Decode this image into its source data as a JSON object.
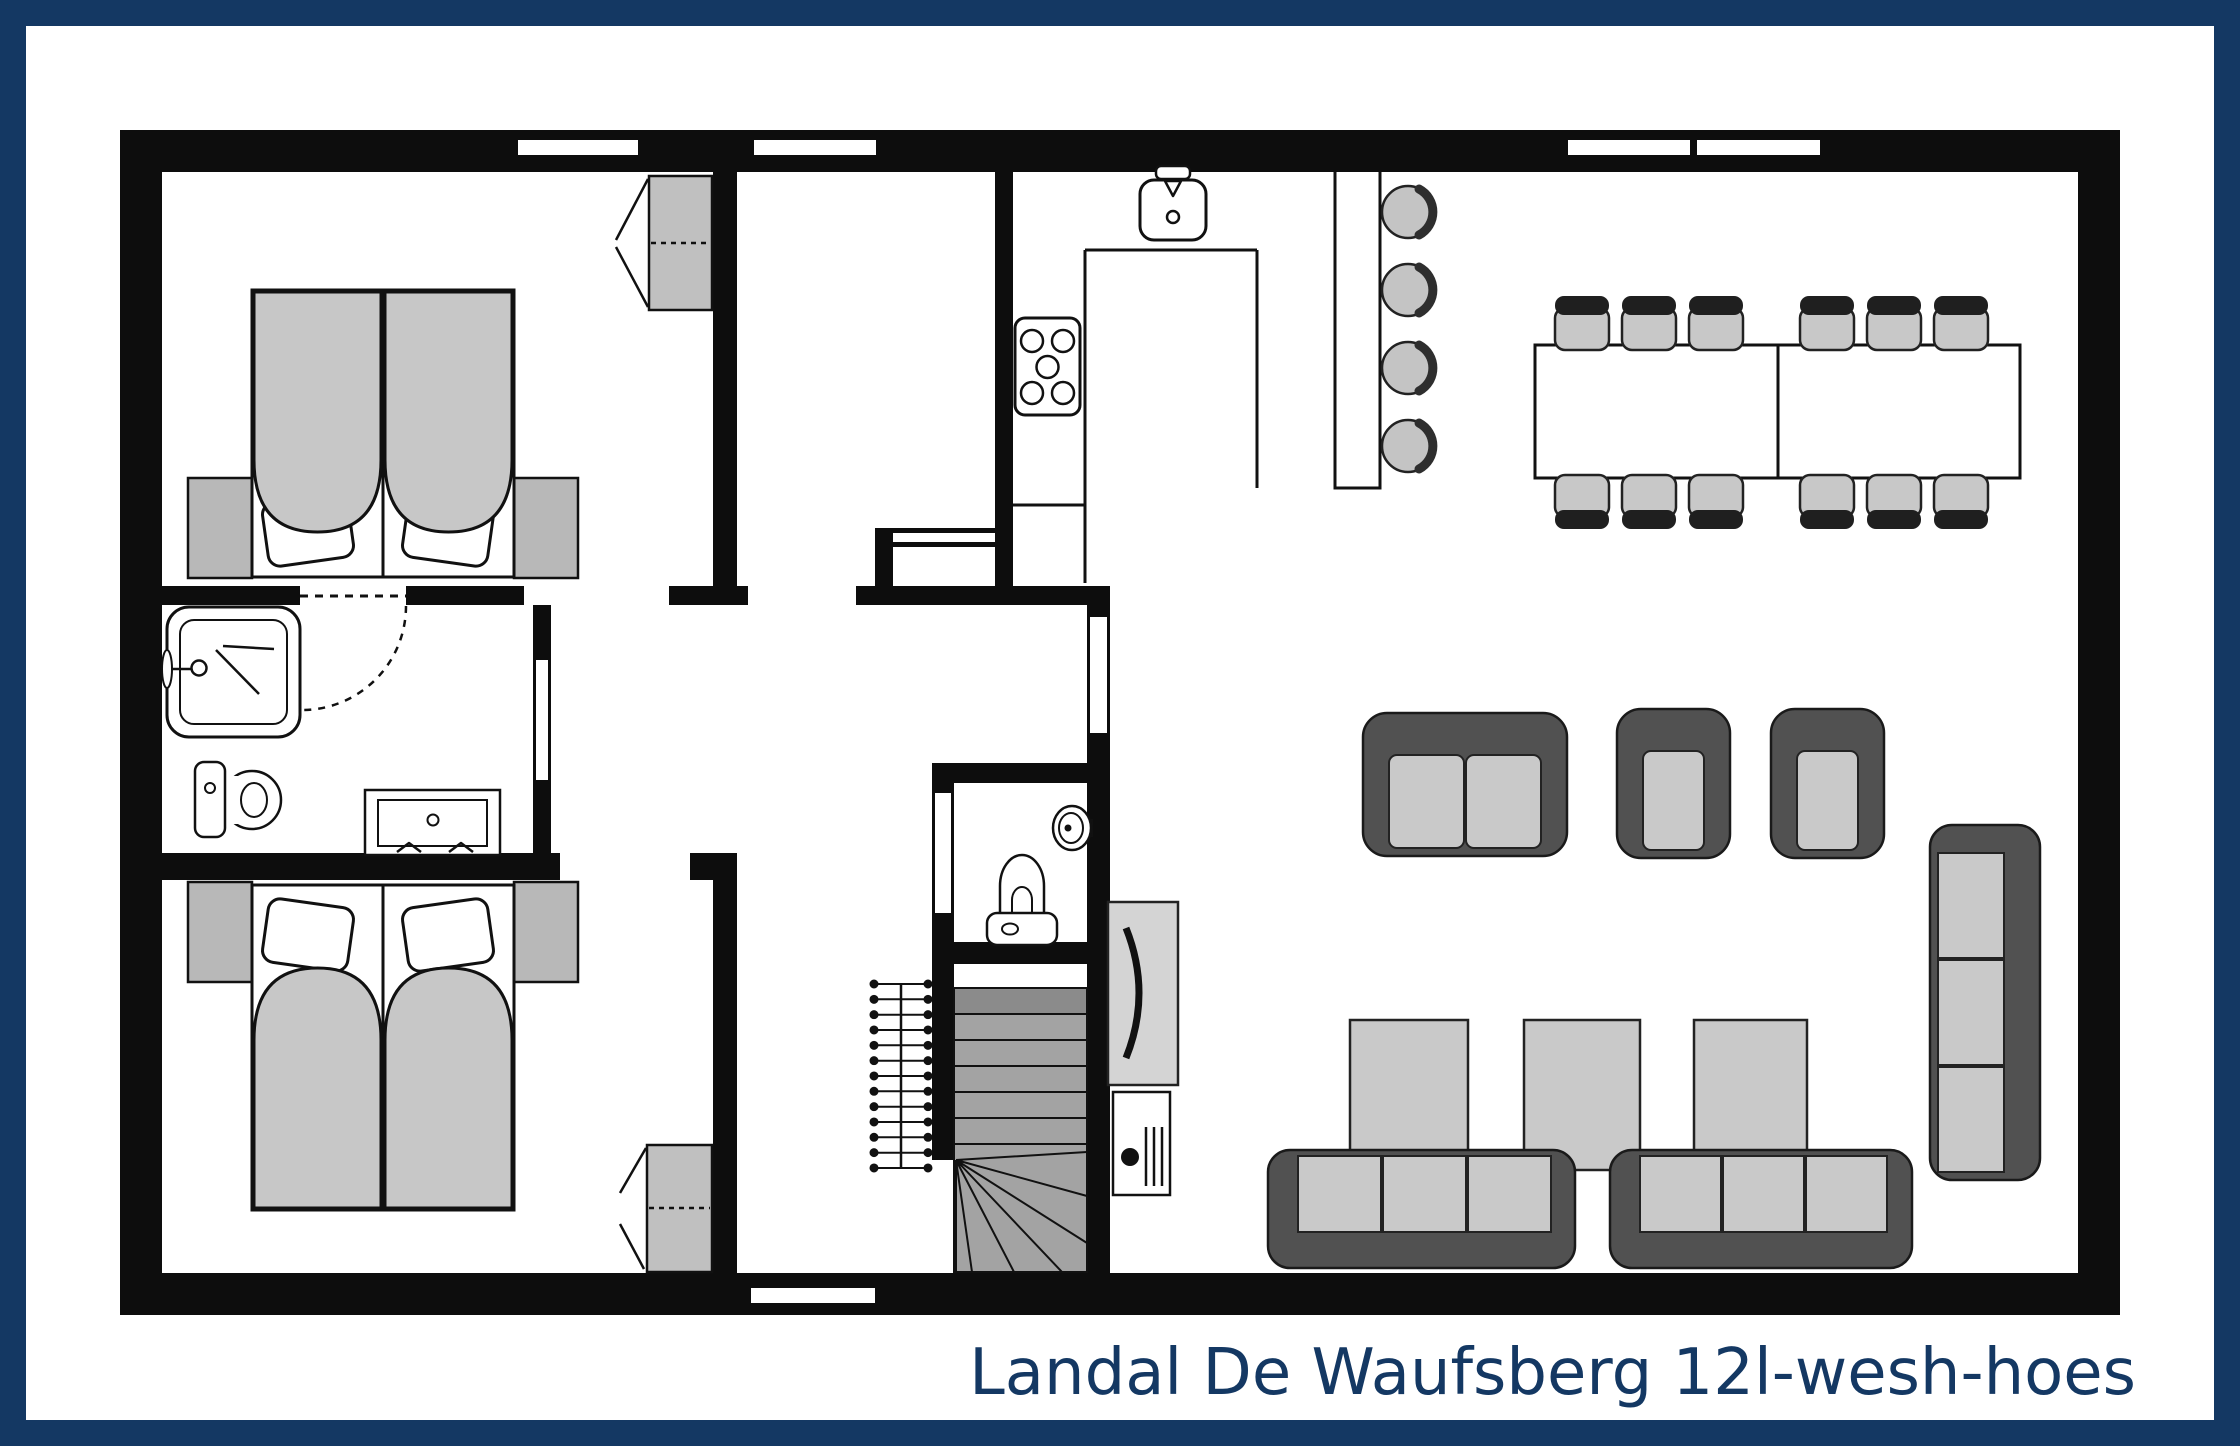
{
  "title": {
    "text": "Landal De Waufsberg 12l-wesh-hoes"
  },
  "colors": {
    "frame": "#143863",
    "title_text": "#143863",
    "wall": "#0d0d0d",
    "floor": "#ffffff",
    "furniture_light_gray": "#c7c7c7",
    "cabinet_gray": "#b8b8b8",
    "upholstery_dark": "#515151",
    "cushion_gray": "#c9c9c9",
    "stair_gray": "#a3a3a3",
    "stair_first_tread": "#8b8b8b",
    "tv_unit_gray": "#d4d4d4"
  },
  "rooms": [
    {
      "name": "bedroom-1",
      "position": "top-left",
      "items": [
        {
          "name": "double-bed",
          "count": 1
        },
        {
          "name": "pillow",
          "count": 2
        },
        {
          "name": "nightstand",
          "count": 2
        },
        {
          "name": "wardrobe",
          "count": 1
        }
      ],
      "openings": [
        "window",
        "door-to-hall"
      ]
    },
    {
      "name": "room-2",
      "position": "top-middle",
      "items": [],
      "openings": [
        "window",
        "door-to-hall"
      ]
    },
    {
      "name": "kitchen",
      "position": "top-center-right",
      "items": [
        {
          "name": "u-shaped-counter",
          "count": 1
        },
        {
          "name": "sink",
          "count": 1
        },
        {
          "name": "hob-5-burners",
          "count": 1
        },
        {
          "name": "bar-counter",
          "count": 1
        },
        {
          "name": "bar-stool",
          "count": 4
        }
      ],
      "openings": []
    },
    {
      "name": "dining-area",
      "position": "top-right",
      "items": [
        {
          "name": "dining-table",
          "count": 2
        },
        {
          "name": "dining-chair",
          "count": 12
        }
      ],
      "openings": [
        "window",
        "window"
      ]
    },
    {
      "name": "living-area",
      "position": "bottom-right",
      "items": [
        {
          "name": "two-seat-sofa",
          "count": 1
        },
        {
          "name": "armchair",
          "count": 2
        },
        {
          "name": "side-table",
          "count": 3
        },
        {
          "name": "three-seat-sofa",
          "count": 3
        },
        {
          "name": "tv-or-fireplace-unit",
          "count": 1
        },
        {
          "name": "stove-heater",
          "count": 1
        }
      ],
      "openings": [
        "door-to-hall"
      ]
    },
    {
      "name": "bathroom",
      "position": "middle-left",
      "items": [
        {
          "name": "shower",
          "count": 1
        },
        {
          "name": "toilet",
          "count": 1
        },
        {
          "name": "washbasin-vanity",
          "count": 1
        }
      ],
      "openings": [
        "door-with-swing-arc",
        "door-to-hall"
      ]
    },
    {
      "name": "bedroom-2",
      "position": "bottom-left",
      "items": [
        {
          "name": "double-bed",
          "count": 1
        },
        {
          "name": "pillow",
          "count": 2
        },
        {
          "name": "nightstand",
          "count": 2
        },
        {
          "name": "wardrobe",
          "count": 1
        }
      ],
      "openings": [
        "door-to-hall"
      ]
    },
    {
      "name": "hallway",
      "position": "bottom-middle",
      "items": [
        {
          "name": "winder-staircase",
          "count": 1
        },
        {
          "name": "stair-railing",
          "count": 1
        },
        {
          "name": "storage-niche",
          "count": 1
        }
      ],
      "openings": [
        "entrance-door"
      ]
    },
    {
      "name": "wc",
      "position": "middle",
      "items": [
        {
          "name": "toilet",
          "count": 1
        },
        {
          "name": "corner-washbasin",
          "count": 1
        }
      ],
      "openings": [
        "door"
      ]
    }
  ],
  "counts": {
    "dining_chairs": 12,
    "bar_stools": 4,
    "sofas": 4,
    "armchairs": 2,
    "side_tables": 3,
    "double_beds": 2,
    "wardrobes": 2,
    "windows_top_wall": 4,
    "bottom_wall_doors": 1
  }
}
